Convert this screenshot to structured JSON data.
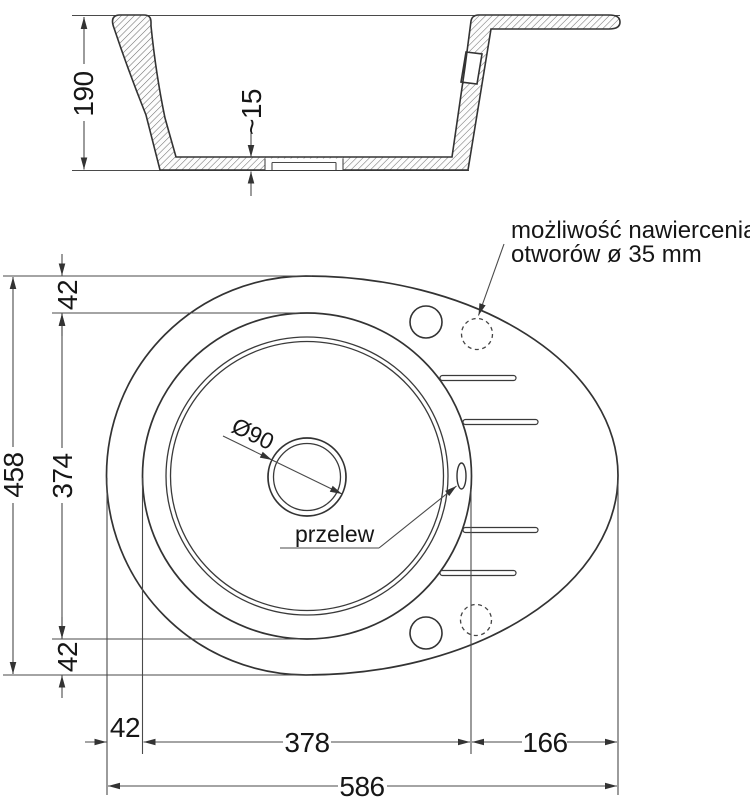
{
  "drawing": {
    "section": {
      "depth_label": "190",
      "floor_thickness_label": "~15"
    },
    "plan": {
      "note_line1": "możliwość nawiercenia",
      "note_line2": "otworów ø 35 mm",
      "drain_diameter_label": "Ø90",
      "overflow_label": "przelew",
      "dim_top_edge": "42",
      "dim_bowl_height": "374",
      "dim_total_height": "458",
      "dim_bottom_edge": "42",
      "dim_left_offset": "42",
      "dim_bowl_width": "378",
      "dim_drainer_width": "166",
      "dim_total_width": "586"
    }
  }
}
